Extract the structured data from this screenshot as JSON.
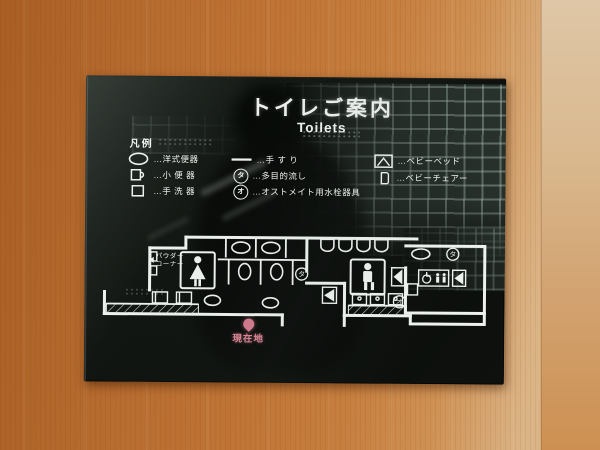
{
  "sign": {
    "title": "トイレご案内",
    "subtitle": "Toilets",
    "legend": {
      "heading": "凡例",
      "col1": [
        {
          "icon": "western-toilet-icon",
          "label": "…洋式便器"
        },
        {
          "icon": "urinal-icon",
          "label": "…小 便 器"
        },
        {
          "icon": "hand-wash-basin-icon",
          "label": "…手 洗 器"
        }
      ],
      "col2": [
        {
          "icon": "handrail-icon",
          "label": "…手 す り"
        },
        {
          "icon": "multipurpose-sink-marker-icon",
          "marker": "タ",
          "label": "…多目的流し"
        },
        {
          "icon": "ostomate-marker-icon",
          "marker": "オ",
          "label": "…オストメイト用水栓器具"
        }
      ],
      "col3": [
        {
          "icon": "baby-bed-icon",
          "label": "…ベビーベッド"
        },
        {
          "icon": "baby-chair-icon",
          "label": "…ベビーチェアー"
        }
      ]
    },
    "map": {
      "powder_corner_line1": "パウダー",
      "powder_corner_line2": "コーナー",
      "current_location": "現在地",
      "marker_ta": "タ",
      "marker_o": "オ"
    },
    "colors": {
      "sign_background": "#0c0f0c",
      "sign_text": "#f0f3ef",
      "current_location_pink": "#dd8495",
      "wood_wall": "#c27a3a"
    }
  }
}
